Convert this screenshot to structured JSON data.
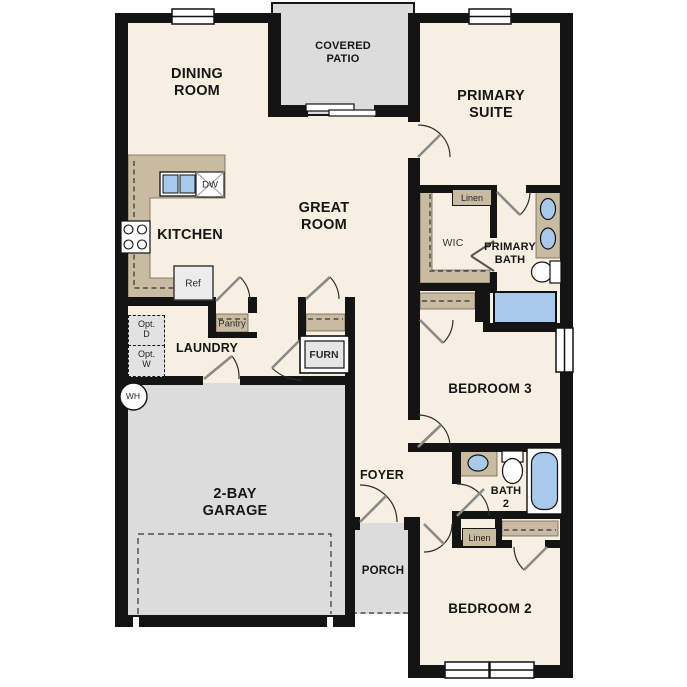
{
  "plan": {
    "rooms": {
      "dining_room": {
        "lines": [
          "DINING",
          "ROOM"
        ]
      },
      "covered_patio": {
        "lines": [
          "COVERED",
          "PATIO"
        ]
      },
      "primary_suite": {
        "lines": [
          "PRIMARY",
          "SUITE"
        ]
      },
      "great_room": {
        "lines": [
          "GREAT",
          "ROOM"
        ]
      },
      "kitchen": {
        "label": "KITCHEN"
      },
      "wic": {
        "label": "WIC"
      },
      "primary_bath": {
        "lines": [
          "PRIMARY",
          "BATH"
        ]
      },
      "laundry": {
        "label": "LAUNDRY"
      },
      "bedroom_3": {
        "label": "BEDROOM 3"
      },
      "foyer": {
        "label": "FOYER"
      },
      "bath_2": {
        "lines": [
          "BATH",
          "2"
        ]
      },
      "garage": {
        "lines": [
          "2-BAY",
          "GARAGE"
        ]
      },
      "porch": {
        "label": "PORCH"
      },
      "bedroom_2": {
        "label": "BEDROOM 2"
      }
    },
    "features": {
      "linen_primary": "Linen",
      "linen_hall": "Linen",
      "pantry": "Pantry",
      "refrigerator": "Ref",
      "dishwasher": "DW",
      "furnace": "FURN",
      "water_heater": "WH",
      "opt_dryer": {
        "lines": [
          "Opt.",
          "D"
        ]
      },
      "opt_washer": {
        "lines": [
          "Opt.",
          "W"
        ]
      }
    },
    "colors": {
      "wall": "#141414",
      "floor": "#f7efe1",
      "concrete": "#dcdcdc",
      "casework": "#c8bba1",
      "fixture_water": "#a9c9ea",
      "appliance": "#ececec"
    }
  }
}
